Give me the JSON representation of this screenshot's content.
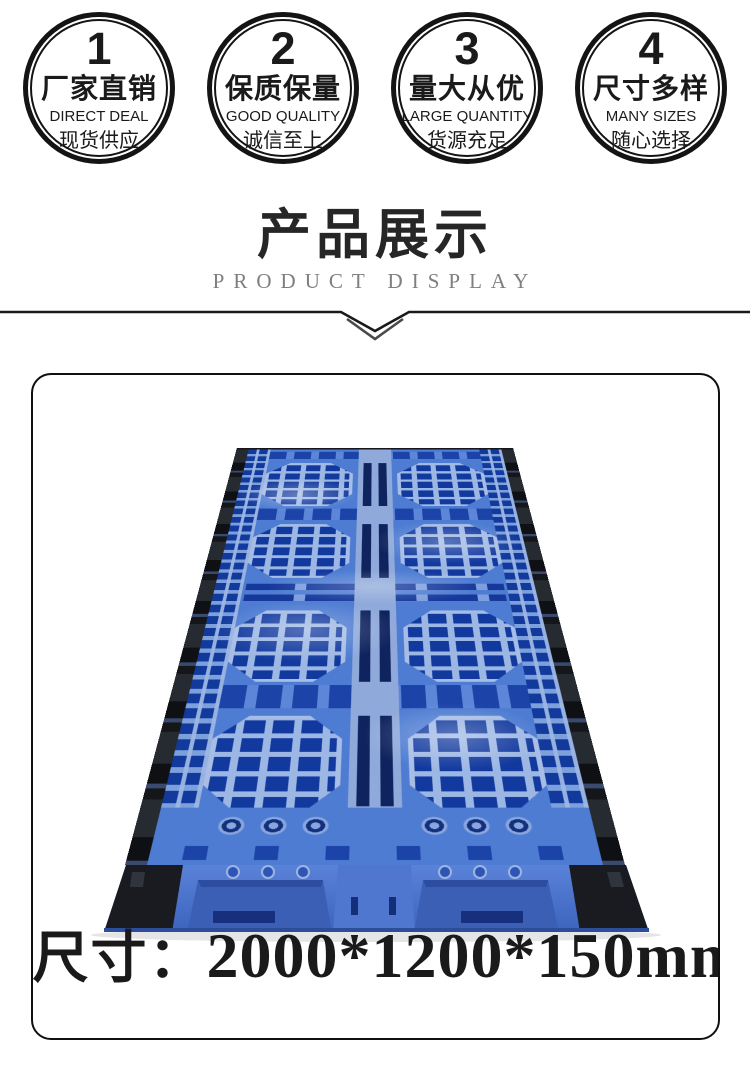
{
  "theme": {
    "ink": "#1a1a1a",
    "gray": "#7f7f7f",
    "frame": "#101010",
    "p-blue": "#4e7cd2",
    "p-blue-lt": "#9db7e4",
    "p-blue-mid": "#5d86d8",
    "p-blue-dk": "#12399e",
    "p-navy": "#0f235e",
    "p-black": "#191b20"
  },
  "badges": [
    {
      "number": "1",
      "title": "厂家直销",
      "subtitle_en": "DIRECT DEAL",
      "subtitle_cn": "现货供应"
    },
    {
      "number": "2",
      "title": "保质保量",
      "subtitle_en": "GOOD QUALITY",
      "subtitle_cn": "诚信至上"
    },
    {
      "number": "3",
      "title": "量大从优",
      "subtitle_en": "LARGE QUANTITY",
      "subtitle_cn": "货源充足"
    },
    {
      "number": "4",
      "title": "尺寸多样",
      "subtitle_en": "MANY SIZES",
      "subtitle_cn": "随心选择"
    }
  ],
  "section": {
    "title": "产品展示",
    "subtitle": "PRODUCT DISPLAY"
  },
  "product": {
    "photo_alt": "blue plastic grid pallet, perspective view, black side rails",
    "size_label": "尺寸：",
    "size_value": "2000*1200*150mm"
  }
}
